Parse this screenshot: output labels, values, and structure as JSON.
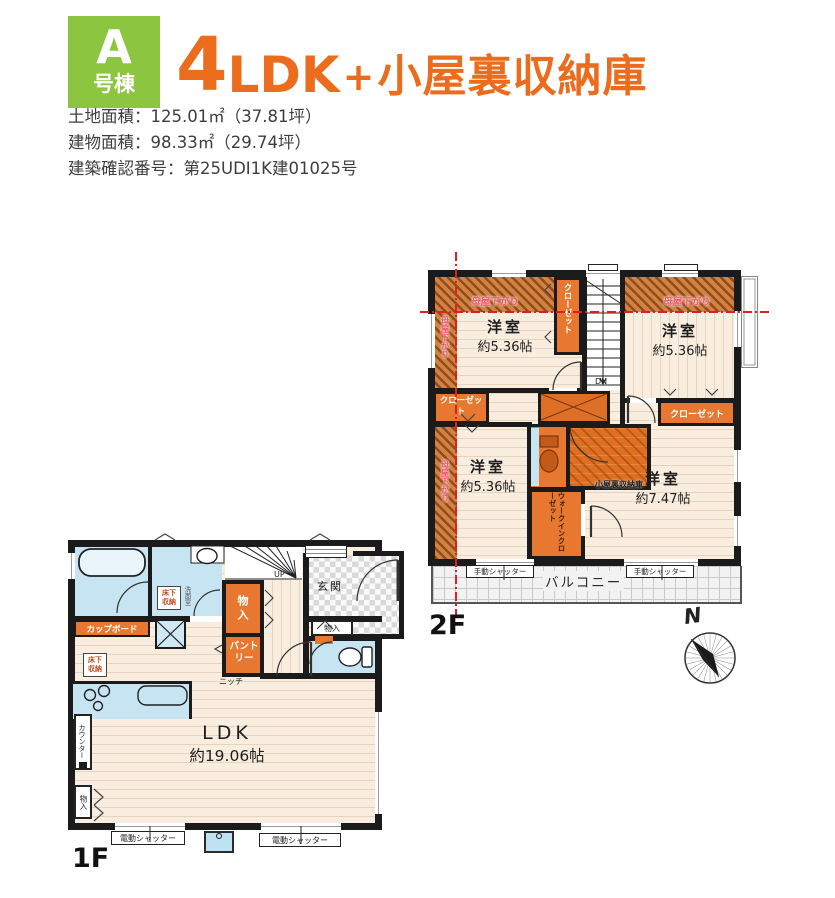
{
  "header": {
    "badge": {
      "letter": "A",
      "suffix": "号棟"
    },
    "title": {
      "num": "4",
      "ldk": "LDK",
      "plus": "+",
      "rest": "小屋裏収納庫"
    },
    "info": [
      "土地面積：125.01㎡（37.81坪）",
      "建物面積：98.33㎡（29.74坪）",
      "建築確認番号：第25UDI1K建01025号"
    ]
  },
  "floor2": {
    "label": "2F",
    "bedroom_nw": {
      "name": "洋室",
      "size": "約5.36帖"
    },
    "bedroom_ne": {
      "name": "洋室",
      "size": "約5.36帖"
    },
    "bedroom_sw": {
      "name": "洋室",
      "size": "約5.36帖"
    },
    "bedroom_se": {
      "name": "洋室",
      "size": "約7.47帖"
    },
    "closet": "クローゼット",
    "wic": "ウォークインクローゼット",
    "attic": "小屋裏収納庫",
    "balcony": "バルコニー",
    "manual_shutter": "手動シャッター",
    "sloped_ceiling": "母屋下がり",
    "down": "DN"
  },
  "floor1": {
    "label": "1F",
    "ldk": {
      "name": "LDK",
      "size": "約19.06帖"
    },
    "entrance": "玄関",
    "storage": "物入",
    "pantry": "パントリー",
    "niche": "ニッチ",
    "cupboard": "カップボード",
    "underfloor": "床下収納",
    "washroom": "洗面室",
    "counter": "カウンター",
    "electric_shutter": "電動シャッター",
    "up": "UP"
  },
  "compass": {
    "north": "N"
  },
  "colors": {
    "accent_orange": "#EB6C1D",
    "badge_green": "#8CC53F",
    "closet_orange": "#E8782F",
    "floor_cream": "#F8EDDE",
    "water_blue": "#C7E4F2",
    "red_line": "#E01F1F",
    "red_text": "#F2566F"
  }
}
